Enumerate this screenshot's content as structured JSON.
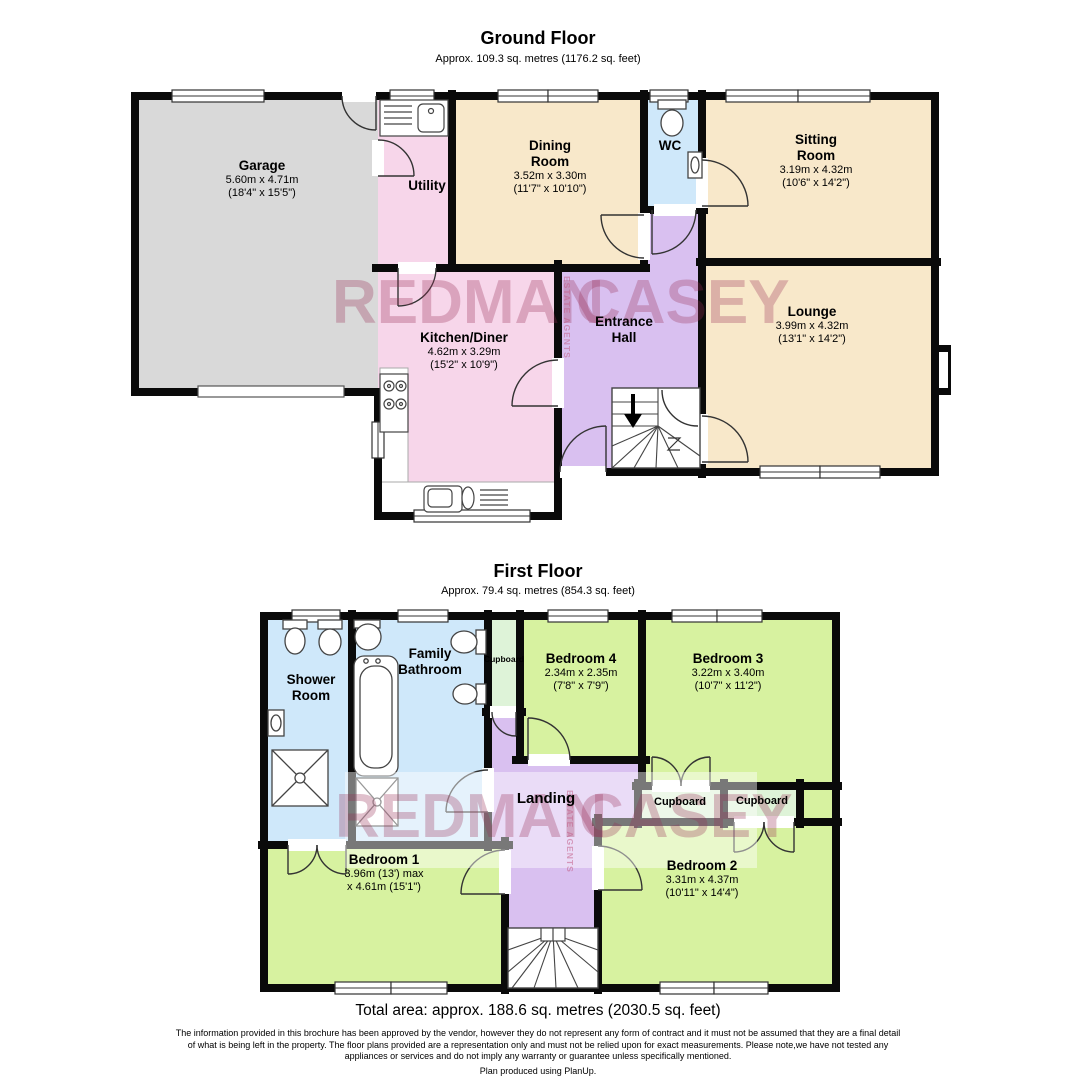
{
  "ground_floor": {
    "title": "Ground Floor",
    "subtitle": "Approx. 109.3 sq. metres (1176.2 sq. feet)",
    "rooms": {
      "garage": {
        "name": "Garage",
        "dim1": "5.60m x 4.71m",
        "dim2": "(18'4\" x 15'5\")"
      },
      "utility": {
        "name": "Utility"
      },
      "dining_room": {
        "name1": "Dining",
        "name2": "Room",
        "dim1": "3.52m x 3.30m",
        "dim2": "(11'7\" x 10'10\")"
      },
      "wc": {
        "name": "WC"
      },
      "sitting_room": {
        "name1": "Sitting",
        "name2": "Room",
        "dim1": "3.19m x 4.32m",
        "dim2": "(10'6\" x 14'2\")"
      },
      "lounge": {
        "name": "Lounge",
        "dim1": "3.99m x 4.32m",
        "dim2": "(13'1\" x 14'2\")"
      },
      "kitchen_diner": {
        "name": "Kitchen/Diner",
        "dim1": "4.62m x 3.29m",
        "dim2": "(15'2\" x 10'9\")"
      },
      "entrance_hall": {
        "name1": "Entrance",
        "name2": "Hall"
      }
    }
  },
  "first_floor": {
    "title": "First Floor",
    "subtitle": "Approx. 79.4 sq. metres (854.3 sq. feet)",
    "rooms": {
      "shower_room": {
        "name1": "Shower",
        "name2": "Room"
      },
      "family_bathroom": {
        "name1": "Family",
        "name2": "Bathroom"
      },
      "cupboard_top": {
        "name": "Cupboard"
      },
      "bedroom4": {
        "name": "Bedroom 4",
        "dim1": "2.34m x 2.35m",
        "dim2": "(7'8\" x 7'9\")"
      },
      "bedroom3": {
        "name": "Bedroom 3",
        "dim1": "3.22m x 3.40m",
        "dim2": "(10'7\" x 11'2\")"
      },
      "landing": {
        "name": "Landing"
      },
      "cupboard_left": {
        "name": "Cupboard"
      },
      "cupboard_right": {
        "name": "Cupboard"
      },
      "bedroom1": {
        "name": "Bedroom 1",
        "dim1": "3.96m (13') max",
        "dim2": "x 4.61m (15'1\")"
      },
      "bedroom2": {
        "name": "Bedroom 2",
        "dim1": "3.31m x 4.37m",
        "dim2": "(10'11\" x 14'4\")"
      }
    }
  },
  "watermark": {
    "word1": "REDMAN",
    "word2": "CASEY",
    "vertical": "ESTATE AGENTS"
  },
  "footer": {
    "total_area": "Total area: approx. 188.6 sq. metres (2030.5 sq. feet)",
    "disclaimer": "The information provided in this brochure has been approved by the vendor, however they do not represent any form of contract and it must not be assumed that they are a final detail of what is being left in the property. The floor plans provided are a representation only and must not be relied upon for exact measurements. Please note,we have not tested any appliances or services and do not imply any warranty or guarantee unless specifically mentioned.",
    "credit": "Plan produced using PlanUp."
  },
  "colors": {
    "wall": "#0a0a0a",
    "tan_room": "#f8e8ca",
    "pink_room": "#f7d6ea",
    "purple_hall": "#d9c0f0",
    "blue_room": "#cfe8fa",
    "gray_garage": "#d9d9d9",
    "green_bedroom": "#d7f2a0",
    "green_cupboard": "#def3d8",
    "watermark_color": "#982d56",
    "white": "#ffffff"
  }
}
